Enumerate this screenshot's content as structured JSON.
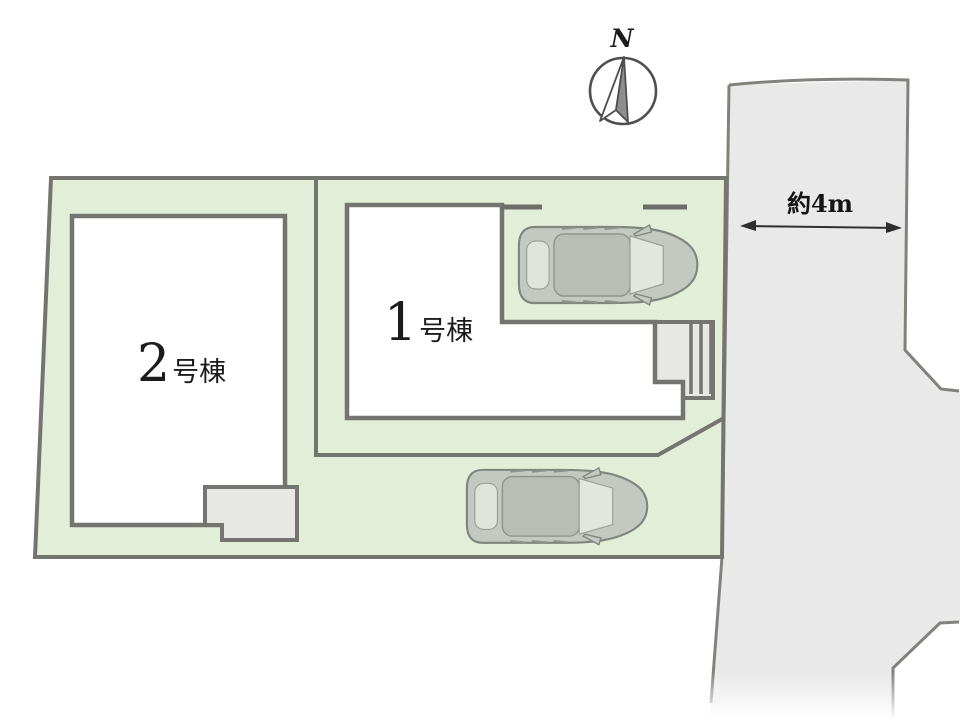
{
  "plan": {
    "compass_label": "N",
    "road_width_label": "約4m",
    "buildings": [
      {
        "number": "1",
        "suffix": "号棟"
      },
      {
        "number": "2",
        "suffix": "号棟"
      }
    ],
    "colors": {
      "lot_fill": "#e3eed9",
      "road_fill": "#e9e9e9",
      "outline": "#757570",
      "car_body": "#c3c8c1"
    }
  }
}
